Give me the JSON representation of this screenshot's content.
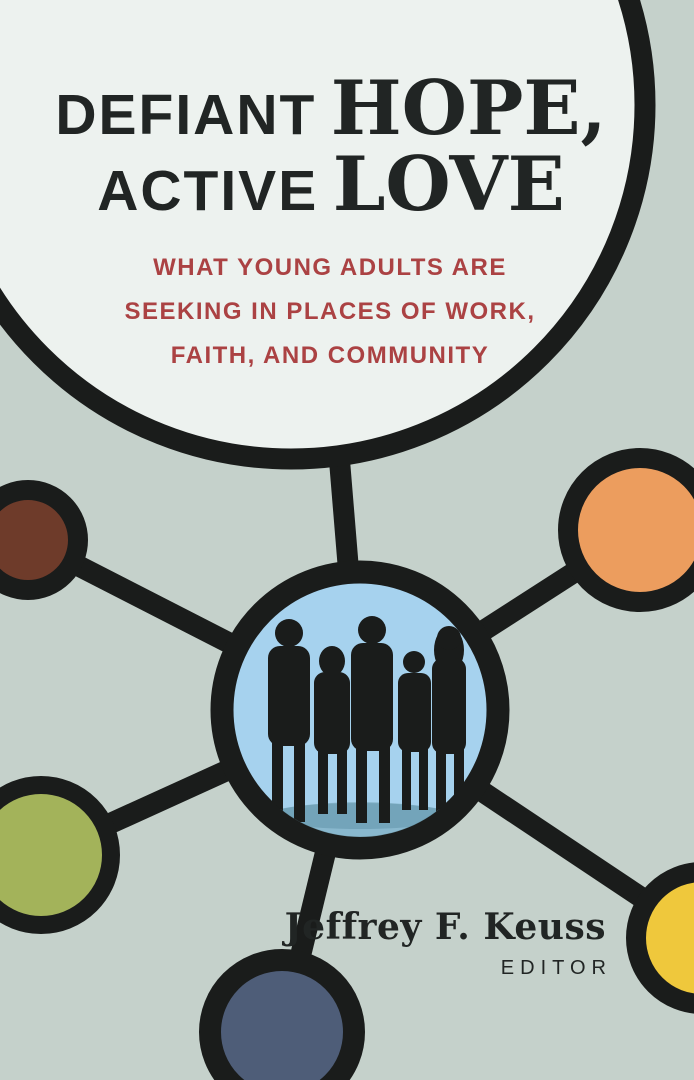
{
  "cover": {
    "title": {
      "word1": "DEFIANT",
      "word2": "HOPE,",
      "word3": "ACTIVE",
      "word4": "LOVE"
    },
    "subtitle": {
      "line1": "WHAT YOUNG ADULTS ARE",
      "line2": "SEEKING IN PLACES OF WORK,",
      "line3": "FAITH, AND COMMUNITY"
    },
    "author": {
      "name": "Jeffrey F. Keuss",
      "role": "EDITOR"
    }
  },
  "icons": {
    "hub": "five-people-silhouette",
    "motif": "network-of-connected-circles"
  },
  "colors": {
    "background": "#c5d1cb",
    "paper": "#edf2ef",
    "ink": "#1a1c1b",
    "title_text": "#212524",
    "accent_red": "#ab4243",
    "hub_blue": "#a6d2ee",
    "node_brown": "#6e3b2a",
    "node_orange": "#ec9d5e",
    "node_olive": "#a3b35a",
    "node_yellow": "#efc83c",
    "node_slate": "#4e5d78",
    "reflection_teal": "#84b4c8"
  }
}
